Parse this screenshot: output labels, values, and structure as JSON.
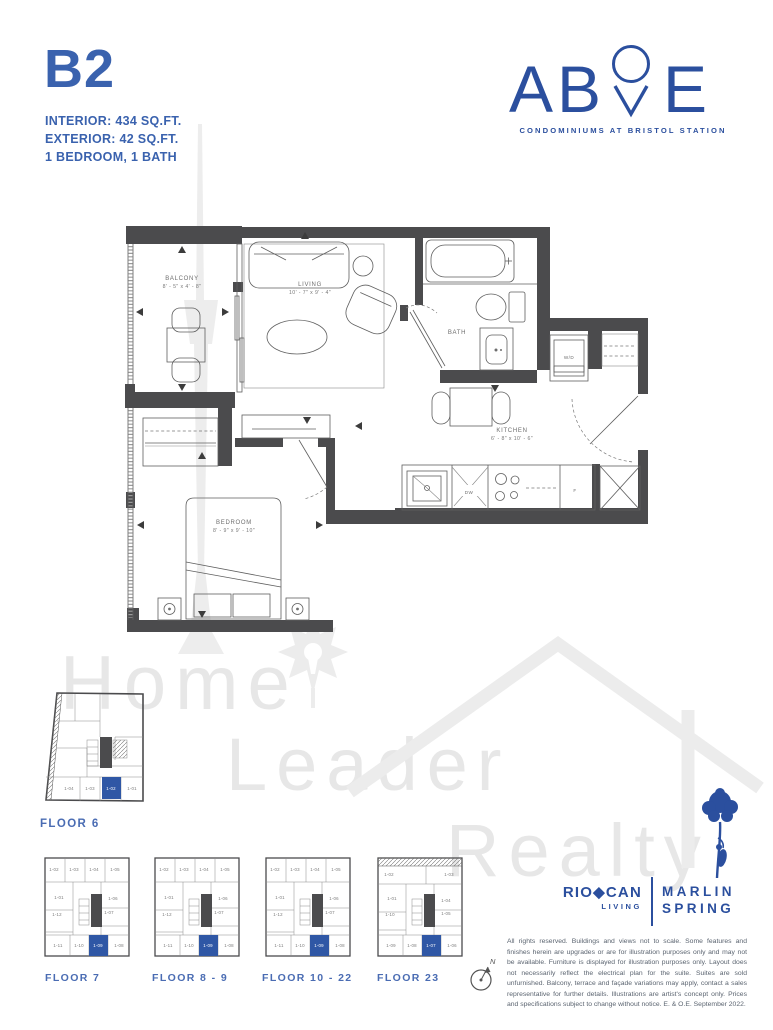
{
  "colors": {
    "brand": "#2b4f9e",
    "accent": "#3a62ae",
    "accent2": "#4a6cb3",
    "wall": "#4b4b4d",
    "highlight": "#2f57a5",
    "wm": "#e7e7e7"
  },
  "unit": {
    "code": "B2",
    "interior": "INTERIOR: 434 SQ.FT.",
    "exterior": "EXTERIOR: 42 SQ.FT.",
    "config": "1 BEDROOM, 1 BATH"
  },
  "brand": {
    "letter_a": "A",
    "letter_b": "B",
    "letter_e": "E",
    "tagline": "CONDOMINIUMS AT BRISTOL STATION"
  },
  "floorplan": {
    "balcony_name": "BALCONY",
    "balcony_dims": "8' - 5\" x 4' - 8\"",
    "living_name": "LIVING",
    "living_dims": "10' - 7\" x 9' - 4\"",
    "bath_name": "BATH",
    "wd_name": "W/D",
    "kitchen_name": "KITCHEN",
    "kitchen_dims": "6' - 8\" x 10' - 6\"",
    "bedroom_name": "BEDROOM",
    "bedroom_dims": "8' - 9\" x 9' - 10\"",
    "dishwasher": "DW",
    "fridge": "F"
  },
  "keyplans": {
    "floor6": {
      "label": "FLOOR 6",
      "highlight": "1-02",
      "units": {
        "b1": "1-04",
        "b2": "1-03",
        "b3": "1-02",
        "b4": "1-01"
      }
    },
    "floor7": {
      "label": "FLOOR 7",
      "highlight": "1-09",
      "units": {
        "t1": "1-02",
        "t2": "1-03",
        "t3": "1-04",
        "t4": "1-05",
        "l1": "1-01",
        "l2": "1-12",
        "r1": "1-06",
        "r2": "1-07",
        "b1": "1-11",
        "b2": "1-10",
        "b3": "1-09",
        "b4": "1-08"
      }
    },
    "floor8_9": {
      "label": "FLOOR 8 - 9",
      "highlight": "1-09",
      "units": {
        "t1": "1-02",
        "t2": "1-03",
        "t3": "1-04",
        "t4": "1-05",
        "l1": "1-01",
        "l2": "1-12",
        "r1": "1-06",
        "r2": "1-07",
        "b1": "1-11",
        "b2": "1-10",
        "b3": "1-09",
        "b4": "1-08"
      }
    },
    "floor10_22": {
      "label": "FLOOR 10 - 22",
      "highlight": "1-09",
      "units": {
        "t1": "1-02",
        "t2": "1-03",
        "t3": "1-04",
        "t4": "1-05",
        "l1": "1-01",
        "l2": "1-12",
        "r1": "1-06",
        "r2": "1-07",
        "b1": "1-11",
        "b2": "1-10",
        "b3": "1-09",
        "b4": "1-08"
      }
    },
    "floor23": {
      "label": "FLOOR 23",
      "highlight": "1-07",
      "units": {
        "t1": "1-02",
        "t2": "1-03",
        "l1": "1-01",
        "l2": "1-10",
        "r1": "1-04",
        "r2": "1-05",
        "b1": "1-09",
        "b2": "1-08",
        "b3": "1-07",
        "b4": "1-06"
      }
    }
  },
  "compass": {
    "north": "N"
  },
  "watermark": {
    "word1": "Home",
    "word2": "Leader",
    "word3": "Realty"
  },
  "footer": {
    "riocan_rio": "RIO",
    "riocan_diamond": "◆",
    "riocan_can": "CAN",
    "riocan_sub": "LIVING",
    "marlin_line1": "MARLIN",
    "marlin_line2": "SPRING",
    "disclaimer": "All rights reserved. Buildings and views not to scale. Some features and finishes herein are upgrades or are for illustration purposes only and may not be available. Furniture is displayed for illustration purposes only. Layout does not necessarily reflect the electrical plan for the suite. Suites are sold unfurnished. Balcony, terrace and façade variations may apply, contact a sales representative for further details. Illustrations are artist's concept only. Prices and specifications subject to change without notice. E. & O.E. September 2022."
  }
}
